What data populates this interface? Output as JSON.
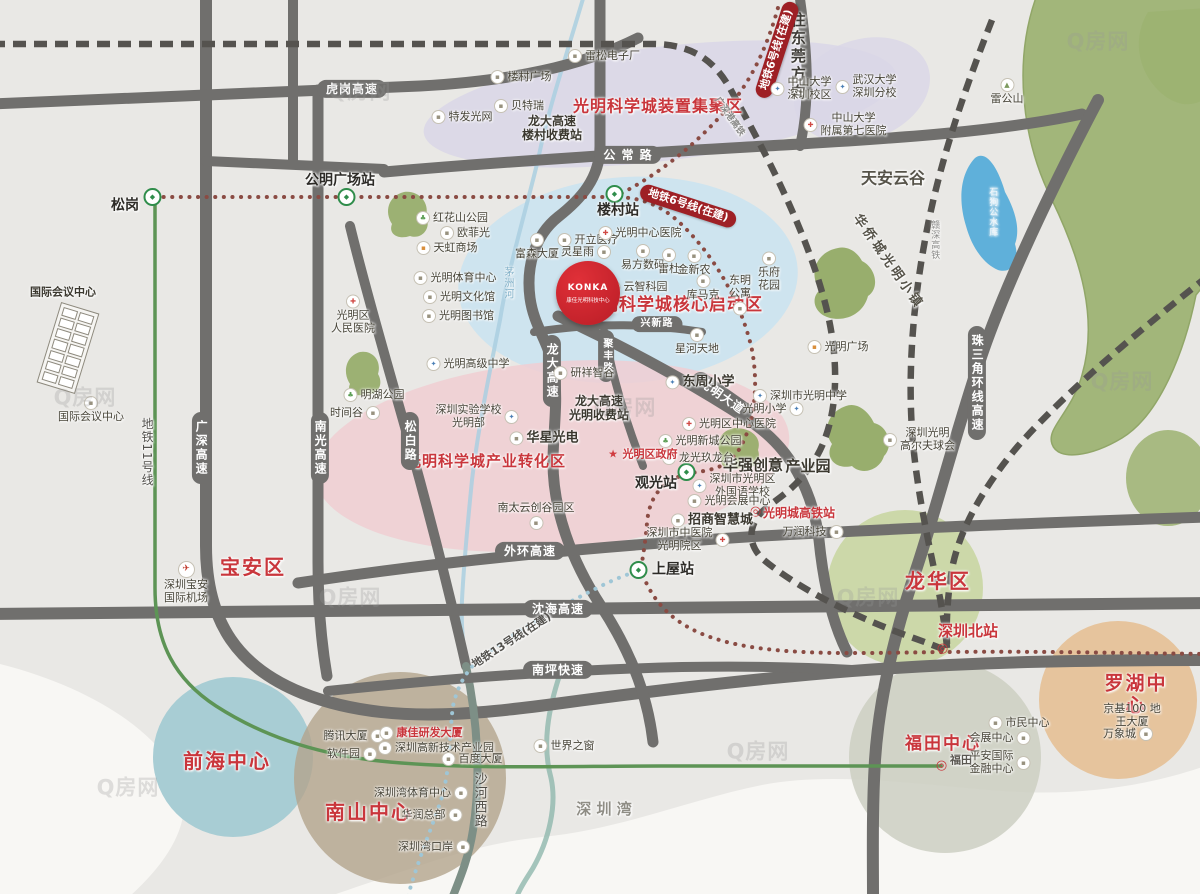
{
  "title": "光明科学城区位示意图",
  "watermark_text": "Q房网",
  "colors": {
    "bg": "#e9e8e5",
    "sea": "#f8f7f4",
    "road": "#706f6d",
    "railline": "#55534f",
    "red": "#c9363c",
    "badge": "#9e2025",
    "metro6": "#8a4b43",
    "metro11": "#5d9455",
    "metro13": "#9fc6d6",
    "river": "#aacfe0",
    "lake": "#5fb0da",
    "hill": "#9cb271",
    "zone_purple": "#d9d6e7",
    "zone_blue": "#cbe3f0",
    "zone_pink": "#f0ced2",
    "circle_longhua": "#c9d6a2",
    "circle_qianhai": "#a8cdd4",
    "circle_nanshan": "#b3a48c",
    "circle_futian": "#cdcfc2",
    "circle_luohu": "#e6c095"
  },
  "icons": {
    "b": "▪",
    "hospital": "✚",
    "school": "✦",
    "park": "♣",
    "mall": "▪",
    "plane": "✈",
    "mount": "▲",
    "metro": "◆",
    "rail": "◎",
    "star": "★"
  },
  "konka": {
    "brand": "KONKA",
    "label": "康佳光明科技中心"
  },
  "markers": [
    {
      "name": "zone-device-cluster",
      "type": "zone",
      "text": "光明科学城装置集聚区",
      "x": 658,
      "y": 107,
      "size": 16
    },
    {
      "name": "zone-core-start",
      "type": "zone",
      "text": "光明科学城核心启动区",
      "x": 673,
      "y": 305,
      "size": 17
    },
    {
      "name": "zone-industry-transform",
      "type": "zone",
      "text": "光明科学城产业转化区",
      "x": 486,
      "y": 462,
      "size": 15
    },
    {
      "name": "district-baoan",
      "type": "district",
      "text": "宝安区",
      "x": 253,
      "y": 568
    },
    {
      "name": "district-longhua",
      "type": "district",
      "text": "龙华区",
      "x": 938,
      "y": 582
    },
    {
      "name": "district-qianhai",
      "type": "district",
      "text": "前海中心",
      "x": 227,
      "y": 762
    },
    {
      "name": "district-nanshan",
      "type": "district",
      "text": "南山中心",
      "x": 369,
      "y": 813
    },
    {
      "name": "district-futian",
      "type": "district",
      "text": "福田中心",
      "x": 943,
      "y": 744,
      "size": 17
    },
    {
      "name": "district-luohu",
      "type": "district",
      "text": "罗湖中心",
      "x": 1136,
      "y": 695,
      "size": 19
    },
    {
      "name": "area-tianan-cloud-valley",
      "type": "area",
      "text": "天安云谷",
      "x": 893,
      "y": 179,
      "size": 16
    },
    {
      "name": "area-shenzhen-bay",
      "type": "area",
      "text": "深 圳 湾",
      "x": 604,
      "y": 810,
      "size": 15,
      "color": "#8f8d85"
    },
    {
      "name": "area-to-dongguan",
      "type": "varea",
      "text": "往东莞方向",
      "x": 797,
      "y": 57,
      "size": 15
    },
    {
      "name": "area-oct-guangming-town",
      "type": "area",
      "text": "华侨城光明小镇",
      "x": 888,
      "y": 262,
      "rot": 55,
      "size": 13,
      "spacing": 3
    },
    {
      "name": "area-huaqiang-chuangyi",
      "type": "bigpoi",
      "text": "华强创意",
      "x": 753,
      "y": 466,
      "size": 15
    },
    {
      "name": "area-chanyeyuan",
      "type": "bigpoi",
      "text": "产业园",
      "x": 808,
      "y": 467,
      "size": 15
    },
    {
      "name": "road-hugang-expwy",
      "type": "pillh",
      "text": "虎岗高速",
      "x": 352,
      "y": 89
    },
    {
      "name": "road-gongchang-rd",
      "type": "pillh",
      "text": "公 常 路",
      "x": 628,
      "y": 155
    },
    {
      "name": "road-waihuan-expwy",
      "type": "pillh",
      "text": "外环高速",
      "x": 530,
      "y": 551
    },
    {
      "name": "road-shenhai-expwy",
      "type": "pillh",
      "text": "沈海高速",
      "x": 558,
      "y": 609
    },
    {
      "name": "road-nanping-expwy",
      "type": "pillh",
      "text": "南坪快速",
      "x": 558,
      "y": 670
    },
    {
      "name": "road-xingxin-rd",
      "type": "pillh",
      "text": "兴新路",
      "x": 657,
      "y": 324,
      "size": 10
    },
    {
      "name": "road-guangshen-expwy",
      "type": "pillv",
      "text": "广深高速",
      "x": 201,
      "y": 448
    },
    {
      "name": "road-nanguang-expwy",
      "type": "pillv",
      "text": "南光高速",
      "x": 320,
      "y": 448
    },
    {
      "name": "road-songbai-rd",
      "type": "pillv",
      "text": "松白路",
      "x": 410,
      "y": 441
    },
    {
      "name": "road-longda-expwy",
      "type": "pillv",
      "text": "龙大高速",
      "x": 552,
      "y": 371
    },
    {
      "name": "road-zhusanjiao-ring-expwy",
      "type": "pillv",
      "text": "珠三角环线高速",
      "x": 977,
      "y": 383
    },
    {
      "name": "road-jufeng-rd",
      "type": "pillv",
      "text": "聚丰路",
      "x": 606,
      "y": 356,
      "size": 10
    },
    {
      "name": "road-guangming-blvd",
      "type": "pillr",
      "text": "光明大道",
      "x": 722,
      "y": 396,
      "rot": 35
    },
    {
      "name": "metro6-badge-east",
      "type": "badge",
      "text": "地铁6号线(在建)",
      "x": 688,
      "y": 206,
      "rot": 18
    },
    {
      "name": "metro6-badge-north",
      "type": "badge",
      "text": "地铁6号线(在建)",
      "x": 777,
      "y": 50,
      "rot": -72
    },
    {
      "name": "metro-line11-label",
      "type": "vtext",
      "text": "地铁11号线",
      "x": 147,
      "y": 452,
      "size": 12,
      "color": "#52504c"
    },
    {
      "name": "metro-line13-label",
      "type": "note",
      "text": "地铁13号线(在建)",
      "x": 512,
      "y": 641,
      "rot": -33,
      "size": 11,
      "color": "#52504c"
    },
    {
      "name": "rail-ganshen-label",
      "type": "vtext",
      "text": "赣深高铁",
      "x": 934,
      "y": 240,
      "size": 9,
      "color": "#8a8a88"
    },
    {
      "name": "rail-guangshengang-label",
      "type": "note",
      "text": "广深港高铁",
      "x": 729,
      "y": 117,
      "rot": 55,
      "size": 9,
      "color": "#8a8a88"
    },
    {
      "name": "river-maozhou-label",
      "type": "vtext",
      "text": "茅洲河",
      "x": 507,
      "y": 283,
      "size": 10,
      "color": "#7fafc7"
    },
    {
      "name": "lake-shigougong-label",
      "type": "vtext",
      "text": "石狗公水库",
      "x": 992,
      "y": 212,
      "size": 9,
      "color": "#f0f6fa"
    },
    {
      "name": "road-shahexi-label",
      "type": "vtext",
      "text": "沙河西路",
      "x": 479,
      "y": 800,
      "size": 13,
      "color": "#4f4c45"
    },
    {
      "name": "station-songgang-icon",
      "type": "micon",
      "text": "",
      "x": 154,
      "y": 197,
      "icon": "metro"
    },
    {
      "name": "station-gongming-icon",
      "type": "micon",
      "text": "",
      "x": 348,
      "y": 197,
      "icon": "metro"
    },
    {
      "name": "station-loucun-icon",
      "type": "micon",
      "text": "",
      "x": 616,
      "y": 194,
      "icon": "metro"
    },
    {
      "name": "station-guanguang-icon",
      "type": "micon",
      "text": "",
      "x": 688,
      "y": 472,
      "icon": "metro"
    },
    {
      "name": "station-shangwu-icon",
      "type": "micon",
      "text": "",
      "x": 640,
      "y": 570,
      "icon": "metro"
    },
    {
      "name": "station-guangmingcheng-icon",
      "type": "micon",
      "text": "",
      "x": 757,
      "y": 512,
      "icon": "rail"
    },
    {
      "name": "station-shenzhenbei-icon",
      "type": "micon",
      "text": "",
      "x": 944,
      "y": 649,
      "icon": "rail"
    },
    {
      "name": "station-futian-icon",
      "type": "micon",
      "text": "",
      "x": 943,
      "y": 766,
      "icon": "rail"
    },
    {
      "name": "station-songgang",
      "type": "station",
      "text": "松岗",
      "x": 125,
      "y": 206
    },
    {
      "name": "station-gongming-plaza",
      "type": "station",
      "text": "公明广场站",
      "x": 340,
      "y": 181
    },
    {
      "name": "station-loucun",
      "type": "station",
      "text": "楼村站",
      "x": 618,
      "y": 211
    },
    {
      "name": "station-guanguang",
      "type": "station",
      "text": "观光站",
      "x": 656,
      "y": 484
    },
    {
      "name": "station-shangwu",
      "type": "station",
      "text": "上屋站",
      "x": 673,
      "y": 570
    },
    {
      "name": "station-guangmingcheng-hsr",
      "type": "rail",
      "text": "光明城高铁站",
      "x": 799,
      "y": 513
    },
    {
      "name": "station-shenzhenbei",
      "type": "rail",
      "text": "深圳北站",
      "x": 968,
      "y": 632,
      "size": 15
    },
    {
      "name": "station-futian",
      "type": "note",
      "text": "福田",
      "x": 961,
      "y": 761,
      "size": 11,
      "color": "#5a5751"
    },
    {
      "name": "poi-leisong-electronics",
      "type": "poi",
      "text": "雷松电子厂",
      "x": 604,
      "y": 56,
      "icon": "b"
    },
    {
      "name": "poi-loucun-plaza",
      "type": "poi",
      "text": "楼村广场",
      "x": 521,
      "y": 77,
      "icon": "b"
    },
    {
      "name": "poi-beiterui",
      "type": "poi",
      "text": "贝特瑞",
      "x": 519,
      "y": 106,
      "icon": "b"
    },
    {
      "name": "poi-tefa-guangwang",
      "type": "poi",
      "text": "特发光网",
      "x": 462,
      "y": 117,
      "icon": "b"
    },
    {
      "name": "note-loucun-toll",
      "type": "note",
      "text": "龙大高速\n楼村收费站",
      "x": 552,
      "y": 128
    },
    {
      "name": "poi-sysu-shenzhen",
      "type": "poi",
      "text": "中山大学\n深圳校区",
      "x": 801,
      "y": 89,
      "icon": "school"
    },
    {
      "name": "poi-whu-shenzhen",
      "type": "poi",
      "text": "武汉大学\n深圳分校",
      "x": 866,
      "y": 87,
      "icon": "school"
    },
    {
      "name": "poi-sysu-7th-hospital",
      "type": "poi",
      "text": "中山大学\n附属第七医院",
      "x": 845,
      "y": 125,
      "icon": "hospital"
    },
    {
      "name": "poi-leigongshan",
      "type": "poi",
      "text": "雷公山",
      "x": 1007,
      "y": 92,
      "icon": "mount",
      "side": "a"
    },
    {
      "name": "poi-honghuashan-park",
      "type": "poi",
      "text": "红花山公园",
      "x": 452,
      "y": 218,
      "icon": "park"
    },
    {
      "name": "poi-oufeiguang",
      "type": "poi",
      "text": "欧菲光",
      "x": 465,
      "y": 233,
      "icon": "b"
    },
    {
      "name": "poi-tianhong-mall",
      "type": "poi",
      "text": "天虹商场",
      "x": 447,
      "y": 248,
      "icon": "mall"
    },
    {
      "name": "poi-gm-sports-center",
      "type": "poi",
      "text": "光明体育中心",
      "x": 455,
      "y": 278,
      "icon": "b"
    },
    {
      "name": "poi-gm-culture-hall",
      "type": "poi",
      "text": "光明文化馆",
      "x": 459,
      "y": 297,
      "icon": "b"
    },
    {
      "name": "poi-gm-library",
      "type": "poi",
      "text": "光明图书馆",
      "x": 458,
      "y": 316,
      "icon": "b"
    },
    {
      "name": "poi-gm-people-hospital",
      "type": "poi",
      "text": "光明区\n人民医院",
      "x": 353,
      "y": 315,
      "icon": "hospital",
      "side": "a"
    },
    {
      "name": "poi-minghu-park",
      "type": "poi",
      "text": "明湖公园",
      "x": 374,
      "y": 395,
      "icon": "park"
    },
    {
      "name": "poi-shijiangu",
      "type": "poi",
      "text": "时间谷",
      "x": 355,
      "y": 413,
      "icon": "b",
      "side": "r"
    },
    {
      "name": "poi-gm-senior-high",
      "type": "poi",
      "text": "光明高级中学",
      "x": 468,
      "y": 364,
      "icon": "school"
    },
    {
      "name": "poi-fusen-tower",
      "type": "poi",
      "text": "富森大厦",
      "x": 537,
      "y": 247,
      "icon": "b",
      "side": "a"
    },
    {
      "name": "poi-kaili-medical",
      "type": "poi",
      "text": "开立医疗",
      "x": 588,
      "y": 240,
      "icon": "b"
    },
    {
      "name": "poi-lingxingyu",
      "type": "poi",
      "text": "灵星雨",
      "x": 586,
      "y": 252,
      "icon": "b",
      "side": "r"
    },
    {
      "name": "poi-gm-central-hospital",
      "type": "poi",
      "text": "光明中心医院",
      "x": 640,
      "y": 233,
      "icon": "hospital"
    },
    {
      "name": "poi-yifang-digital",
      "type": "poi",
      "text": "易方数码",
      "x": 643,
      "y": 258,
      "icon": "b",
      "side": "a"
    },
    {
      "name": "poi-leidu",
      "type": "poi",
      "text": "雷杜",
      "x": 669,
      "y": 262,
      "icon": "b",
      "side": "a"
    },
    {
      "name": "poi-jinxinnong",
      "type": "poi",
      "text": "金新农",
      "x": 694,
      "y": 263,
      "icon": "b",
      "side": "a"
    },
    {
      "name": "poi-yunzhi-keyuan",
      "type": "poi",
      "text": "云智科园",
      "x": 637,
      "y": 287,
      "icon": "b"
    },
    {
      "name": "poi-kumake",
      "type": "poi",
      "text": "库马克",
      "x": 703,
      "y": 288,
      "icon": "b",
      "side": "a"
    },
    {
      "name": "poi-dongming-apartment",
      "type": "poi",
      "text": "东明\n公寓",
      "x": 740,
      "y": 295,
      "icon": "b",
      "side": "u"
    },
    {
      "name": "poi-lefu-garden",
      "type": "poi",
      "text": "乐府\n花园",
      "x": 769,
      "y": 272,
      "icon": "b",
      "side": "a"
    },
    {
      "name": "poi-xinghe-tiandi",
      "type": "poi",
      "text": "星河天地",
      "x": 697,
      "y": 342,
      "icon": "b",
      "side": "a"
    },
    {
      "name": "poi-yanxiang-zhigu",
      "type": "poi",
      "text": "研祥智谷",
      "x": 584,
      "y": 373,
      "icon": "b"
    },
    {
      "name": "poi-dongzhou-primary",
      "type": "bigpoi",
      "text": "东周小学",
      "x": 700,
      "y": 382,
      "icon": "school"
    },
    {
      "name": "poi-gm-middle-school",
      "type": "poi",
      "text": "深圳市光明中学",
      "x": 800,
      "y": 396,
      "icon": "school"
    },
    {
      "name": "poi-gm-primary",
      "type": "poi",
      "text": "光明小学",
      "x": 773,
      "y": 409,
      "icon": "school",
      "side": "r"
    },
    {
      "name": "poi-gm-central-district-hospital",
      "type": "poi",
      "text": "光明区中心医院",
      "x": 729,
      "y": 424,
      "icon": "hospital"
    },
    {
      "name": "poi-gm-xincheng-park",
      "type": "poi",
      "text": "光明新城公园",
      "x": 700,
      "y": 441,
      "icon": "park"
    },
    {
      "name": "poi-longguang-jiulongtai",
      "type": "poi",
      "text": "龙光玖龙台",
      "x": 698,
      "y": 458,
      "icon": "b"
    },
    {
      "name": "poi-gm-foreign-language-school",
      "type": "poi",
      "text": "深圳市光明区\n外国语学校",
      "x": 734,
      "y": 486,
      "icon": "school"
    },
    {
      "name": "poi-gm-convention-center",
      "type": "poi",
      "text": "光明会展中心",
      "x": 729,
      "y": 501,
      "icon": "b"
    },
    {
      "name": "poi-zhaoshang-wisdom-city",
      "type": "bigpoi",
      "text": "招商智慧城",
      "x": 712,
      "y": 520,
      "icon": "b"
    },
    {
      "name": "poi-tcm-hospital-gm",
      "type": "poi",
      "text": "深圳市中医院\n光明院区",
      "x": 688,
      "y": 540,
      "icon": "hospital",
      "side": "r"
    },
    {
      "name": "poi-wanrun-tech",
      "type": "poi",
      "text": "万润科技",
      "x": 813,
      "y": 532,
      "icon": "b",
      "side": "r"
    },
    {
      "name": "poi-gm-plaza",
      "type": "poi",
      "text": "光明广场",
      "x": 838,
      "y": 347,
      "icon": "mall"
    },
    {
      "name": "poi-gm-golf-club",
      "type": "poi",
      "text": "深圳光明\n高尔夫球会",
      "x": 919,
      "y": 440,
      "icon": "b"
    },
    {
      "name": "poi-shenzhen-experimental-school",
      "type": "poi",
      "text": "深圳实验学校\n光明部",
      "x": 477,
      "y": 417,
      "icon": "school",
      "side": "r"
    },
    {
      "name": "poi-huaxing-optoelectronics",
      "type": "bigpoi",
      "text": "华星光电",
      "x": 544,
      "y": 438,
      "icon": "b"
    },
    {
      "name": "note-gm-toll",
      "type": "note",
      "text": "龙大高速\n光明收费站",
      "x": 599,
      "y": 408
    },
    {
      "name": "poi-nantai-yunchuanggu",
      "type": "poi",
      "text": "南太云创谷园区",
      "x": 536,
      "y": 516,
      "icon": "b",
      "side": "u"
    },
    {
      "name": "poi-gm-district-government",
      "type": "poired",
      "text": "光明区政府",
      "x": 642,
      "y": 455,
      "icon": "star"
    },
    {
      "name": "poi-baoan-airport",
      "type": "poi",
      "text": "深圳宝安\n国际机场",
      "x": 186,
      "y": 583,
      "icon": "plane",
      "side": "a"
    },
    {
      "name": "poi-tencent-tower",
      "type": "poi",
      "text": "腾讯大厦",
      "x": 354,
      "y": 736,
      "icon": "b",
      "side": "r"
    },
    {
      "name": "poi-konka-rd-tower",
      "type": "poired",
      "text": "康佳研发大厦",
      "x": 421,
      "y": 733,
      "icon": "b"
    },
    {
      "name": "poi-software-park",
      "type": "poi",
      "text": "软件园",
      "x": 352,
      "y": 754,
      "icon": "b",
      "side": "r"
    },
    {
      "name": "poi-hightech-park",
      "type": "poi",
      "text": "深圳高新技术产业园",
      "x": 436,
      "y": 748,
      "icon": "b"
    },
    {
      "name": "poi-baidu-tower",
      "type": "poi",
      "text": "百度大厦",
      "x": 472,
      "y": 759,
      "icon": "b"
    },
    {
      "name": "poi-shenzhen-bay-sports",
      "type": "poi",
      "text": "深圳湾体育中心",
      "x": 421,
      "y": 793,
      "icon": "b",
      "side": "r"
    },
    {
      "name": "poi-huarun-hq",
      "type": "poi",
      "text": "华润总部",
      "x": 432,
      "y": 815,
      "icon": "b",
      "side": "r"
    },
    {
      "name": "poi-shenzhen-bay-port",
      "type": "poi",
      "text": "深圳湾口岸",
      "x": 434,
      "y": 847,
      "icon": "b",
      "side": "r"
    },
    {
      "name": "poi-window-of-world",
      "type": "poi",
      "text": "世界之窗",
      "x": 564,
      "y": 746,
      "icon": "b"
    },
    {
      "name": "poi-civic-center",
      "type": "poi",
      "text": "市民中心",
      "x": 1019,
      "y": 723,
      "icon": "b"
    },
    {
      "name": "poi-convention-center",
      "type": "poi",
      "text": "会展中心",
      "x": 1000,
      "y": 738,
      "icon": "b",
      "side": "r"
    },
    {
      "name": "poi-pingan-ifc",
      "type": "poi",
      "text": "平安国际\n金融中心",
      "x": 1000,
      "y": 763,
      "icon": "b",
      "side": "r"
    },
    {
      "name": "poi-kingkey100",
      "type": "poi",
      "text": "京基100  地王大厦",
      "x": 1132,
      "y": 716
    },
    {
      "name": "poi-mixc",
      "type": "poi",
      "text": "万象城",
      "x": 1128,
      "y": 734,
      "icon": "b",
      "side": "r"
    },
    {
      "name": "poi-intl-conference-top",
      "type": "note",
      "text": "国际会议中心",
      "x": 63,
      "y": 293,
      "size": 11
    },
    {
      "name": "poi-intl-conference",
      "type": "poi",
      "text": "国际会议中心",
      "x": 91,
      "y": 410,
      "icon": "b",
      "side": "a"
    },
    {
      "name": "watermark-1",
      "type": "wm",
      "text": "Q房网",
      "x": 360,
      "y": 92
    },
    {
      "name": "watermark-2",
      "type": "wm",
      "text": "Q房网",
      "x": 85,
      "y": 398
    },
    {
      "name": "watermark-3",
      "type": "wm",
      "text": "Q房网",
      "x": 350,
      "y": 598
    },
    {
      "name": "watermark-4",
      "type": "wm",
      "text": "Q房网",
      "x": 625,
      "y": 408
    },
    {
      "name": "watermark-5",
      "type": "wm",
      "text": "Q房网",
      "x": 868,
      "y": 598
    },
    {
      "name": "watermark-6",
      "type": "wm",
      "text": "Q房网",
      "x": 1098,
      "y": 42
    },
    {
      "name": "watermark-7",
      "type": "wm",
      "text": "Q房网",
      "x": 128,
      "y": 788
    },
    {
      "name": "watermark-8",
      "type": "wm",
      "text": "Q房网",
      "x": 758,
      "y": 752
    },
    {
      "name": "watermark-9",
      "type": "wm",
      "text": "Q房网",
      "x": 1122,
      "y": 382
    }
  ]
}
